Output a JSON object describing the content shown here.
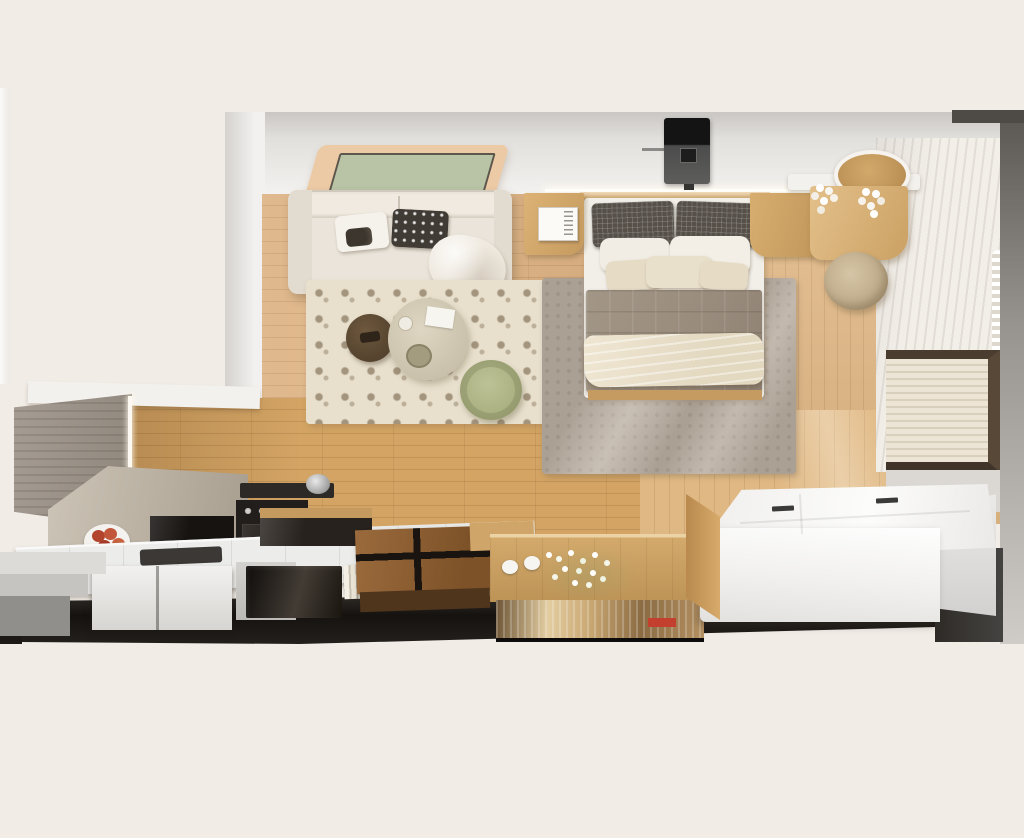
{
  "scene": {
    "title": "Top-down 3D cutaway render of a studio apartment floor plan",
    "style": "photorealistic architectural visualization, no text or UI controls",
    "rooms": [
      {
        "name": "living-room",
        "label": "Living room",
        "items": [
          "l-shaped-cream-sofa",
          "leaf-pattern-pillow",
          "black-dotted-pillow",
          "fur-throw",
          "speckled-shag-rug",
          "dark-round-side-table",
          "cream-round-coffee-table",
          "sage-green-pouf",
          "recessed-ceiling-light-panel"
        ]
      },
      {
        "name": "bedroom",
        "label": "Bedroom",
        "items": [
          "double-bed",
          "checked-dark-pillows",
          "white-pillows",
          "cream-accent-pillows",
          "taupe-quilted-blanket",
          "cream-foot-throw",
          "wood-headboard-shelf",
          "led-light-strip",
          "ceiling-projector",
          "left-nightstand-with-book",
          "right-nightstand",
          "gray-shag-area-rug",
          "vanity-desk",
          "round-wall-mirror",
          "white-flower-vases",
          "round-wicker-stool",
          "sheer-curtains",
          "roller-blind-window"
        ]
      },
      {
        "name": "kitchen-and-media-wall",
        "label": "Kitchen / media wall (cutaway elevation)",
        "items": [
          "tall-gray-wardrobe",
          "led-edge-light",
          "oak-plank-accent-wall",
          "stone-counter",
          "fruit-plate-with-apples",
          "built-in-microwave",
          "oven-with-knobs",
          "cooktop-with-pot",
          "steel-kettle",
          "white-tiled-island-counter",
          "undermount-sink",
          "white-base-cabinets",
          "gray-steps",
          "dark-glass-cabinet",
          "row-of-books",
          "walnut-coffee-table",
          "wood-media-console",
          "white-cups",
          "babys-breath-flowers",
          "mirrored-display-shelf",
          "red-accent-object",
          "white-storage-platform-with-lift-lids",
          "cut-floor-slab-edge"
        ]
      }
    ]
  },
  "palette": {
    "bg": "#f1ece6",
    "floor": "#ddb181",
    "wallWood": "#d3a464",
    "sofa": "#eae4da",
    "rugLiving": "#e8e0cd",
    "rugBedroom": "#aba094",
    "ceilTan": "#eccaa5",
    "ceilSage": "#b9c3a5",
    "poufGreen": "#b4bb8e",
    "pillowDark": "#565049",
    "pillowCream": "#e6dcc6",
    "blanket": "#998b7c",
    "bedWood": "#c69b61",
    "curtain": "#f2eee8",
    "frameBrown": "#4a3c2e",
    "island": "#ececea",
    "glossDark": "#19150f",
    "walnut": "#8a5c33",
    "console": "#c9a065",
    "accentRed": "#c4402e",
    "platform": "#f7f6f4",
    "slab": "#151210",
    "wallGray": "#97938f"
  }
}
